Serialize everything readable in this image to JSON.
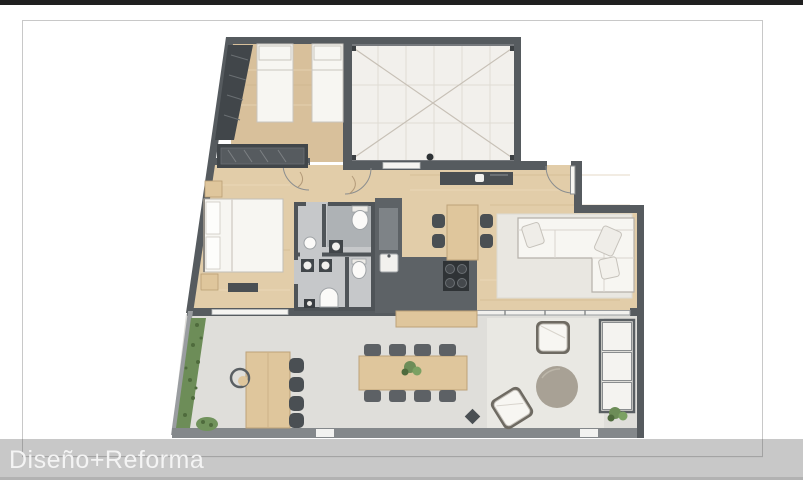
{
  "caption": {
    "title": "Diseño+Reforma"
  },
  "palette": {
    "page_bg": "#ffffff",
    "letterbox": "#202020",
    "frame_border": "#c8c8c8",
    "caption_bar": "rgba(194,194,194,0.9)",
    "caption_text": "#f4f4f4",
    "wall": "#565b5f",
    "wall_light": "#9a9da0",
    "patio_wall": "#76797d",
    "wood": "#e2cda9",
    "wood_dark": "#d8c09b",
    "wood_furniture": "#dfc69c",
    "terrace": "#dfdeda",
    "patio": "#f2f0ec",
    "bath": "#c6c8ca",
    "bath_dark": "#aeb2b5",
    "counter": "#5d6266",
    "counter_panel": "#7e8387",
    "appliance": "#2f3336",
    "white_f": "#f7f6f2",
    "outline": "#b5b1aa",
    "rug": "#e9e7e1",
    "chair": "#4a4f53",
    "chair_gray": "#5d6165",
    "green": "#6d8d58",
    "green_dark": "#4f6b3d",
    "round_table": "#a8a195"
  }
}
